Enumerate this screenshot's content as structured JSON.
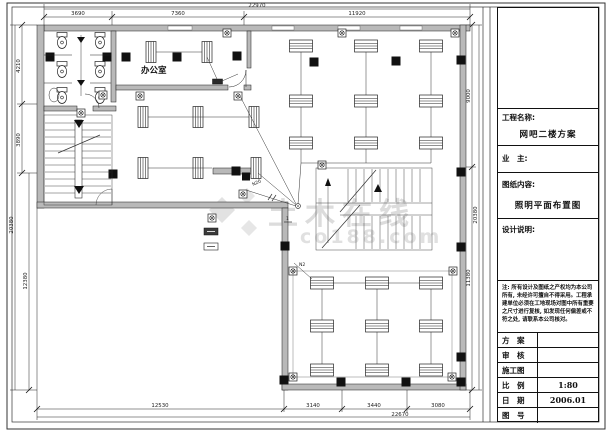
{
  "watermark": {
    "line1": "土木在线",
    "line2": "co188.com"
  },
  "plan": {
    "room_label_office": "办公室",
    "wire_label_1": "N20",
    "wire_label_2": "N2",
    "circuit_label": "1"
  },
  "dimensions": {
    "top": {
      "total": "22970",
      "seg1": "3690",
      "seg2": "7360",
      "seg3": "11920"
    },
    "bottom": {
      "total": "22670",
      "seg1": "12530",
      "seg2": "3140",
      "seg3": "3440",
      "seg4": "3080"
    },
    "left": {
      "total": "20380",
      "seg1": "4210",
      "seg2": "3890",
      "seg3": "12380"
    },
    "right": {
      "total": "20380",
      "seg1": "9000",
      "seg2": "11380"
    }
  },
  "title_block": {
    "project_label": "工程名称:",
    "project_name": "网吧二楼方案",
    "owner_label": "业　主:",
    "content_label": "图纸内容:",
    "content_name": "照明平面布置图",
    "design_notes_label": "设计说明:",
    "disclaimer": "注: 所有设计及图纸之产权均为本公司所有, 未经许可擅自不得采用。工程承建单位必须在工地现场对图中所有重要之尺寸进行复核, 如发现任何偏差或不符之处, 请联系本公司核对。",
    "rows": [
      {
        "label": "方　案",
        "value": ""
      },
      {
        "label": "审　核",
        "value": ""
      },
      {
        "label": "施工图",
        "value": ""
      },
      {
        "label": "比　例",
        "value": "1:80"
      },
      {
        "label": "日　期",
        "value": "2006.01"
      },
      {
        "label": "图　号",
        "value": ""
      }
    ]
  }
}
